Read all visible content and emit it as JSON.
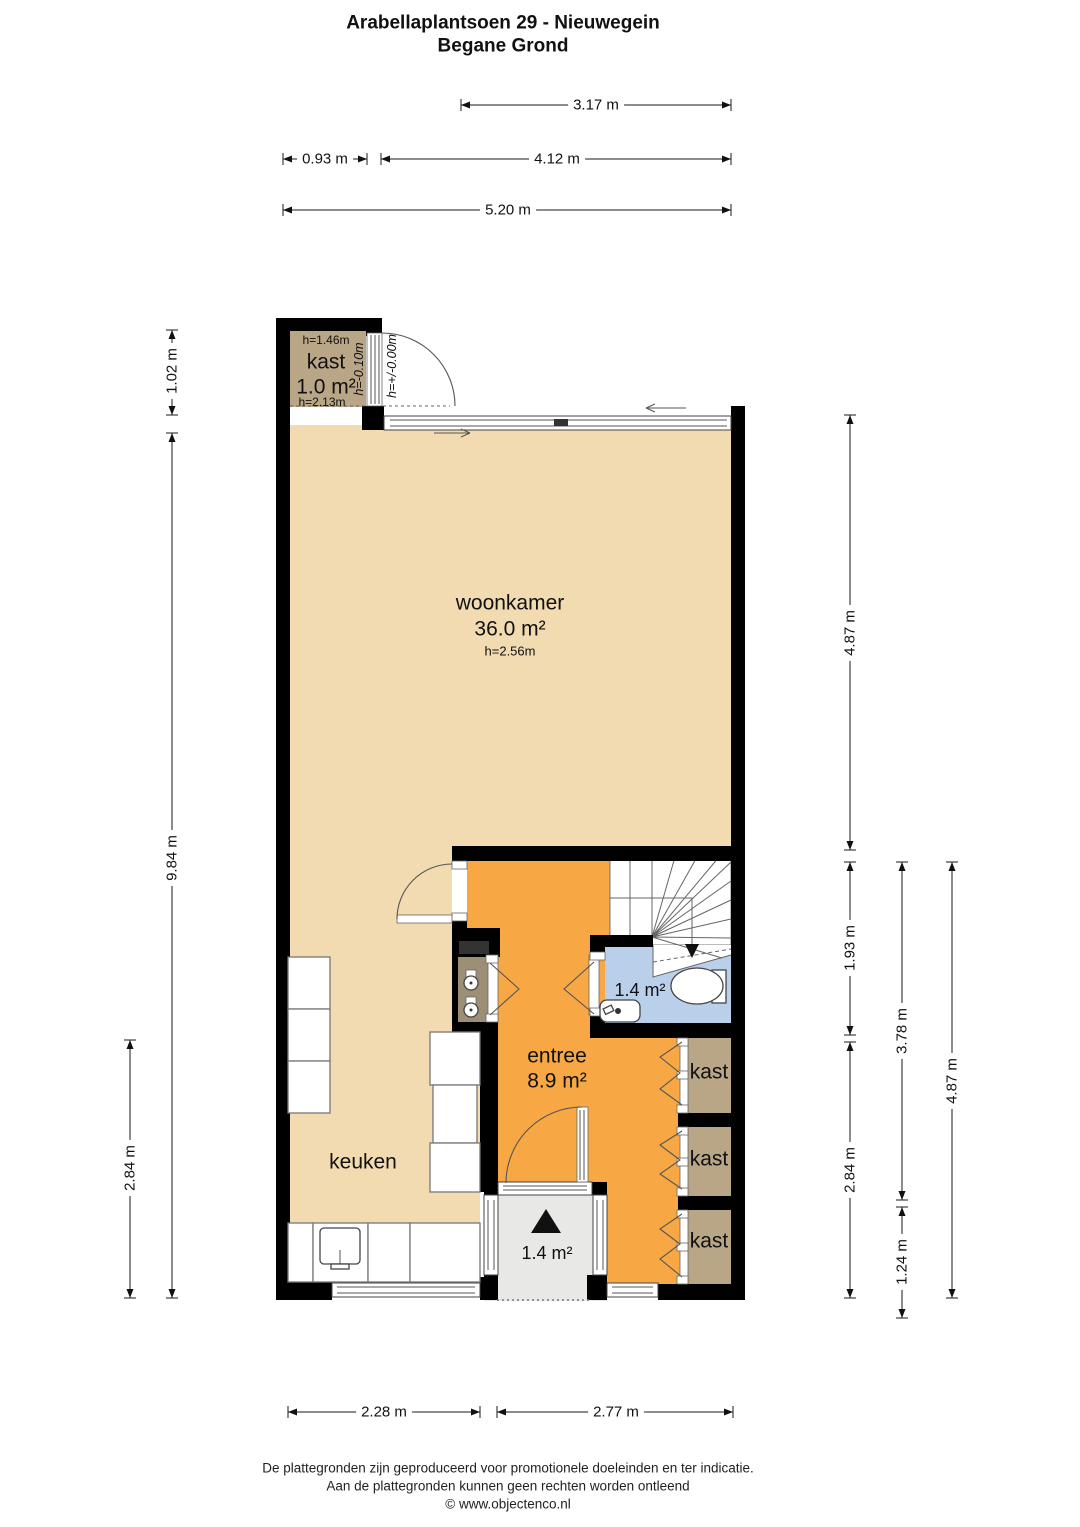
{
  "title": {
    "line1": "Arabellaplantsoen 29 - Nieuwegein",
    "line2": "Begane Grond"
  },
  "dimensions": {
    "top": [
      {
        "label": "3.17 m"
      },
      {
        "label": "0.93 m"
      },
      {
        "label": "4.12 m"
      },
      {
        "label": "5.20 m"
      }
    ],
    "left": [
      {
        "label": "1.02 m"
      },
      {
        "label": "9.84 m"
      },
      {
        "label": "2.84 m"
      }
    ],
    "right": [
      {
        "label": "4.87 m"
      },
      {
        "label": "1.93 m"
      },
      {
        "label": "2.84 m"
      },
      {
        "label": "3.78 m"
      },
      {
        "label": "1.24 m"
      },
      {
        "label": "4.87 m"
      }
    ],
    "bottom": [
      {
        "label": "2.28 m"
      },
      {
        "label": "2.77 m"
      }
    ]
  },
  "rooms": {
    "storage": {
      "name": "kast",
      "area": "1.0 m²",
      "height_upper": "h=1.46m",
      "height_lower": "h=2.13m"
    },
    "living": {
      "name": "woonkamer",
      "area": "36.0 m²",
      "height": "h=2.56m"
    },
    "kitchen": {
      "name": "keuken"
    },
    "hall": {
      "name": "entree",
      "area": "8.9 m²"
    },
    "toilet": {
      "area": "1.4 m²"
    },
    "porch": {
      "area": "1.4 m²"
    },
    "closet1": {
      "name": "kast"
    },
    "closet2": {
      "name": "kast"
    },
    "closet3": {
      "name": "kast"
    }
  },
  "levels": {
    "inner": "h=-0.10m",
    "outer": "h=+/-0.00m"
  },
  "footer": {
    "line1": "De plattegronden zijn geproduceerd voor promotionele doeleinden en ter indicatie.",
    "line2": "Aan de plattegronden kunnen geen rechten worden ontleend",
    "line3": "© www.objectenco.nl"
  },
  "colors": {
    "floor_tan": "#f2dbb1",
    "floor_orange": "#f7a845",
    "closet_brown": "#b8a687",
    "meter_brown": "#9c8f75",
    "toilet_blue": "#bacfe9",
    "porch_grey": "#e8e8e6",
    "wall_black": "#000000"
  }
}
